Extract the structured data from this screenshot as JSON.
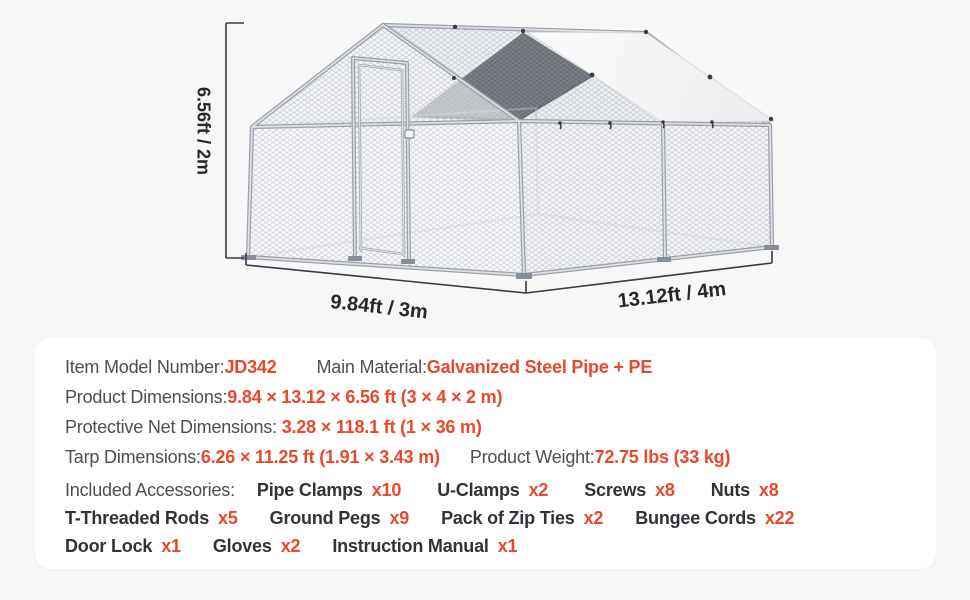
{
  "page": {
    "background": "#f7f7f8",
    "accent": "#e8492a"
  },
  "illustration": {
    "height_label": "6.56ft / 2m",
    "width_label": "9.84ft / 3m",
    "depth_label": "13.12ft / 4m"
  },
  "specs": {
    "row1": {
      "label1": "Item Model Number:",
      "value1": "JD342",
      "label2": "Main Material:",
      "value2": "Galvanized Steel Pipe + PE"
    },
    "row2": {
      "label": "Product Dimensions:",
      "value": "9.84 × 13.12 × 6.56 ft (3 × 4 × 2 m)"
    },
    "row3": {
      "label": "Protective Net Dimensions: ",
      "value": "3.28 × 118.1 ft (1 × 36 m)"
    },
    "row4": {
      "label1": "Tarp Dimensions:",
      "value1": "6.26 × 11.25 ft (1.91 × 3.43 m)",
      "label2": "Product Weight:",
      "value2": "72.75 lbs (33 kg)"
    },
    "accessories_label": "Included Accessories:",
    "acc_rows": [
      [
        {
          "name": "Pipe Clamps",
          "qty": "x10"
        },
        {
          "name": "U-Clamps",
          "qty": "x2"
        },
        {
          "name": "Screws",
          "qty": "x8"
        },
        {
          "name": "Nuts",
          "qty": "x8"
        }
      ],
      [
        {
          "name": "T-Threaded Rods",
          "qty": "x5"
        },
        {
          "name": "Ground Pegs",
          "qty": "x9"
        },
        {
          "name": "Pack of Zip Ties",
          "qty": "x2"
        },
        {
          "name": "Bungee Cords",
          "qty": "x22"
        }
      ],
      [
        {
          "name": "Door Lock",
          "qty": "x1"
        },
        {
          "name": "Gloves",
          "qty": "x2"
        },
        {
          "name": "Instruction Manual",
          "qty": "x1"
        }
      ]
    ]
  }
}
